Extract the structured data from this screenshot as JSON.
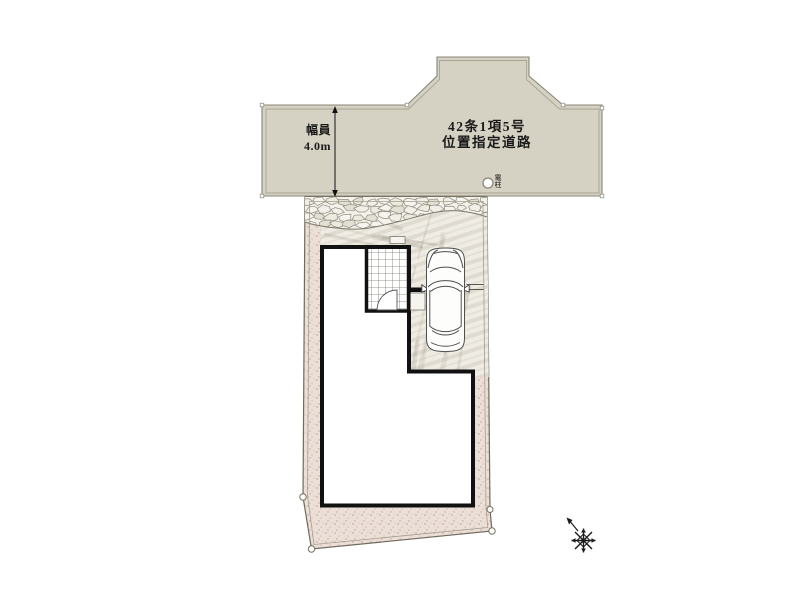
{
  "road": {
    "designation_line1": "42条1項5号",
    "designation_line2": "位置指定道路",
    "width_label": "幅員",
    "width_value": "4.0m"
  },
  "pole": {
    "label": "電柱"
  },
  "colors": {
    "road_fill": "#d6d2c3",
    "road_edge": "#8a8677",
    "soil": "#ebdfd7",
    "concrete": "#efece4",
    "stone_bg": "#f4f2eb",
    "outline": "#111111",
    "text": "#1a1a1a"
  }
}
